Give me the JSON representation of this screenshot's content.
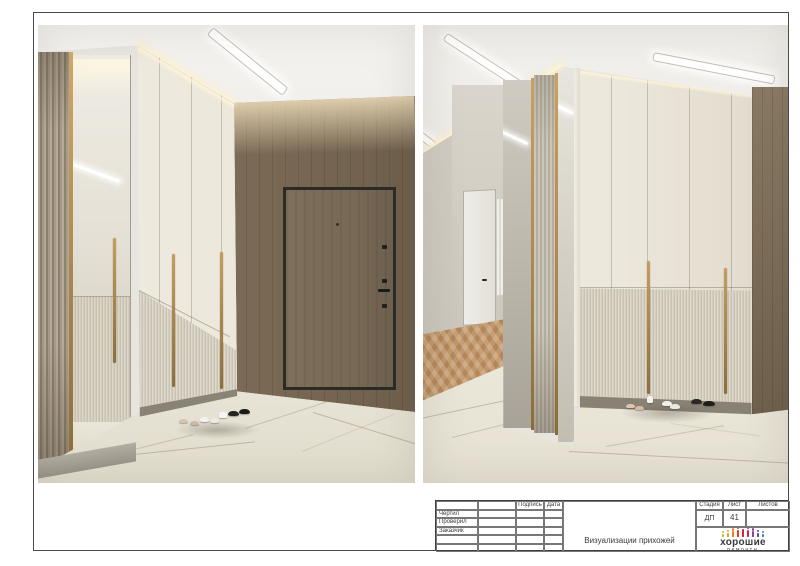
{
  "title_block": {
    "labels": {
      "drawn_by": "Чертил",
      "checked_by": "Проверил",
      "client": "Заказчик",
      "signature": "Подпись",
      "date": "Дата",
      "stage": "Стадия",
      "sheet": "Лист",
      "sheets": "Листов"
    },
    "values": {
      "stage": "ДП",
      "sheet": "41",
      "sheets": ""
    },
    "drawing_title": "Визуализации прихожей"
  },
  "logo": {
    "line1": "хорошие",
    "line2": "ремонты",
    "icon_colors": [
      "#b5c33a",
      "#f39c1f",
      "#ef7d1a",
      "#e23b2e",
      "#d6242c",
      "#d81f5a",
      "#8e3f97",
      "#4b4fa3",
      "#2f86c5"
    ]
  },
  "colors": {
    "brass": "#ab8850",
    "wood": "#7d6c57",
    "door": "#786955",
    "door-frame": "#2c2a26",
    "cream": "#ece7db",
    "fluted": "#d2ccbd",
    "floor": "#edeade",
    "ceiling": "#f1efeb",
    "wall-grey": "#cdc8bf",
    "herring-a": "#c89f74",
    "herring-b": "#b28759",
    "glow": "#fff3d6",
    "line": "#4a4a4a",
    "text": "#3a3a3a"
  }
}
